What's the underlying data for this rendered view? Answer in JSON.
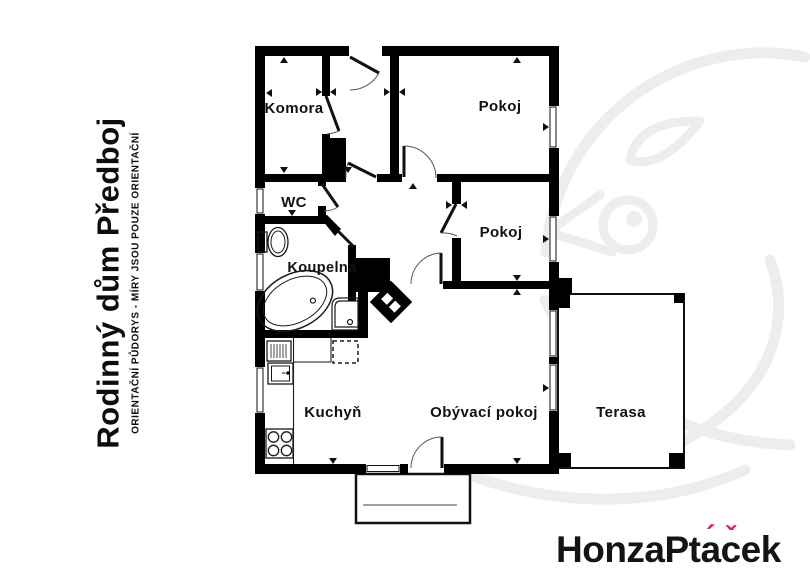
{
  "title": {
    "main": "Rodinný dům Předboj",
    "subtitle": "ORIENTAČNÍ PŮDORYS - MÍRY JSOU POUZE ORIENTAČNÍ"
  },
  "rooms": {
    "komora": "Komora",
    "pokoj1": "Pokoj",
    "wc": "WC",
    "koupelna": "Koupelna",
    "pokoj2": "Pokoj",
    "kuchyn": "Kuchyň",
    "obyvaci_pokoj": "Obývací pokoj",
    "terasa": "Terasa"
  },
  "logo": {
    "full_text": "HonzaPtáček",
    "part1": "HonzaPt",
    "a_base": "a",
    "a_accent": "´",
    "c_base": "c",
    "c_accent": "ˇ",
    "part2": "ek"
  },
  "colors": {
    "wall": "#000000",
    "background": "#ffffff",
    "watermark": "#ededed",
    "logo_text": "#141414",
    "logo_accent": "#e8197d"
  }
}
